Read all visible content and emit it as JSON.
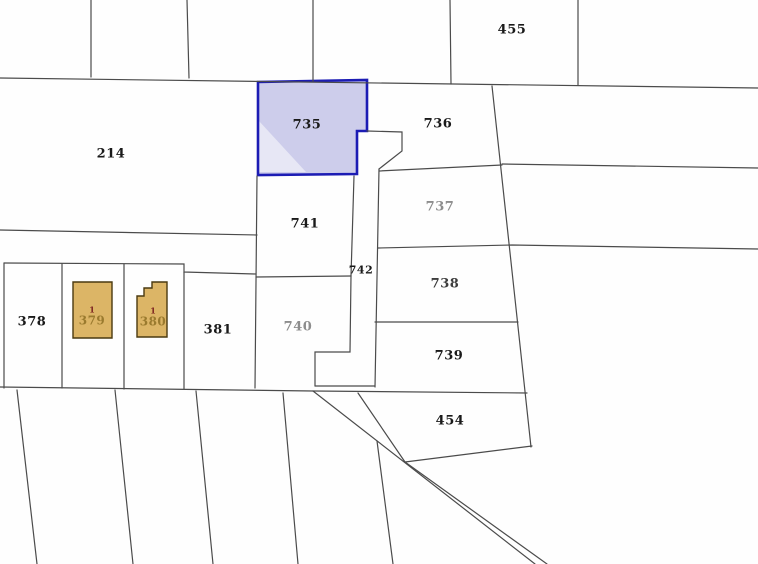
{
  "map": {
    "type": "cadastral-parcel-map",
    "background_color": "#fefefe",
    "boundary_line_color": "#4b4b4b",
    "highlight": {
      "selected_parcel": "735",
      "border_color": "#1c1cb4",
      "fill_color": "#cdcdeb",
      "light_fill_color": "#e7e7f5"
    },
    "building_style": {
      "fill_color": "#dcb566",
      "border_color": "#4a3a10",
      "number_color": "#9a7a2e",
      "unit_color": "#7a1f1f"
    },
    "parcels": [
      {
        "id": "455",
        "label": "455",
        "x": 512,
        "y": 30,
        "color": "#1a1a1a",
        "size": 13
      },
      {
        "id": "214",
        "label": "214",
        "x": 111,
        "y": 154,
        "color": "#1a1a1a",
        "size": 13
      },
      {
        "id": "735",
        "label": "735",
        "x": 307,
        "y": 125,
        "color": "#1a1a1a",
        "size": 13
      },
      {
        "id": "736",
        "label": "736",
        "x": 438,
        "y": 124,
        "color": "#1a1a1a",
        "size": 13
      },
      {
        "id": "737",
        "label": "737",
        "x": 440,
        "y": 207,
        "color": "#8d8d8d",
        "size": 13
      },
      {
        "id": "741",
        "label": "741",
        "x": 305,
        "y": 224,
        "color": "#1a1a1a",
        "size": 13
      },
      {
        "id": "742",
        "label": "742",
        "x": 361,
        "y": 270,
        "color": "#1a1a1a",
        "size": 11
      },
      {
        "id": "738",
        "label": "738",
        "x": 445,
        "y": 284,
        "color": "#3d3d3d",
        "size": 13
      },
      {
        "id": "740",
        "label": "740",
        "x": 298,
        "y": 327,
        "color": "#8d8d8d",
        "size": 13
      },
      {
        "id": "739",
        "label": "739",
        "x": 449,
        "y": 356,
        "color": "#1a1a1a",
        "size": 13
      },
      {
        "id": "378",
        "label": "378",
        "x": 32,
        "y": 322,
        "color": "#1a1a1a",
        "size": 13
      },
      {
        "id": "381",
        "label": "381",
        "x": 218,
        "y": 330,
        "color": "#1a1a1a",
        "size": 13
      },
      {
        "id": "454",
        "label": "454",
        "x": 450,
        "y": 421,
        "color": "#1a1a1a",
        "size": 13
      }
    ],
    "buildings": [
      {
        "parcel": "379",
        "unit_label": "1",
        "number_label": "379",
        "x": 92,
        "y": 317
      },
      {
        "parcel": "380",
        "unit_label": "1",
        "number_label": "380",
        "x": 153,
        "y": 318
      }
    ]
  }
}
